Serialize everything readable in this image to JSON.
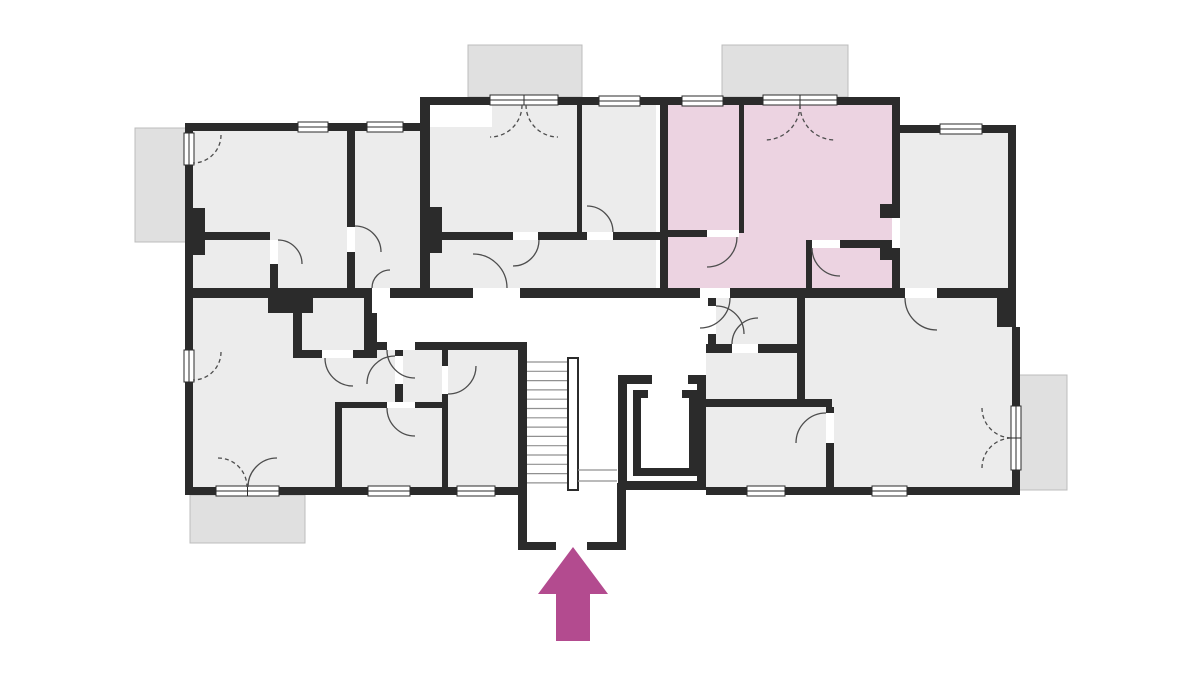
{
  "canvas": {
    "width": 1200,
    "height": 675,
    "background": "#ffffff"
  },
  "palette": {
    "wall": "#2b2b2b",
    "room": "#ececec",
    "highlight_room": "#ecd3e1",
    "balcony_fill": "#e0e0e0",
    "balcony_stroke": "#bcbcbc",
    "door_arc": "#4d4d4d",
    "stair_line": "#909090",
    "window_line": "#2b2b2b",
    "arrow": "#b34b8f",
    "white": "#ffffff"
  },
  "balconies": [
    {
      "x": 135,
      "y": 128,
      "w": 52,
      "h": 114
    },
    {
      "x": 468,
      "y": 45,
      "w": 114,
      "h": 52
    },
    {
      "x": 722,
      "y": 45,
      "w": 126,
      "h": 52
    },
    {
      "x": 190,
      "y": 495,
      "w": 115,
      "h": 48
    },
    {
      "x": 1018,
      "y": 375,
      "w": 49,
      "h": 115
    }
  ],
  "rooms": [
    {
      "x": 189,
      "y": 127,
      "w": 235,
      "h": 169,
      "highlight": false
    },
    {
      "x": 426,
      "y": 103,
      "w": 230,
      "h": 193,
      "highlight": false
    },
    {
      "x": 664,
      "y": 103,
      "w": 232,
      "h": 193,
      "highlight": true
    },
    {
      "x": 896,
      "y": 129,
      "w": 112,
      "h": 167,
      "highlight": false
    },
    {
      "x": 189,
      "y": 293,
      "w": 334,
      "h": 198,
      "highlight": false
    },
    {
      "x": 706,
      "y": 293,
      "w": 306,
      "h": 198,
      "highlight": false
    }
  ],
  "white_areas": [
    {
      "x": 372,
      "y": 293,
      "w": 344,
      "h": 57
    },
    {
      "x": 430,
      "y": 105,
      "w": 62,
      "h": 22
    }
  ],
  "walls": [
    {
      "x": 185,
      "y": 123,
      "w": 8,
      "h": 372
    },
    {
      "x": 185,
      "y": 123,
      "w": 243,
      "h": 8
    },
    {
      "x": 420,
      "y": 97,
      "w": 10,
      "h": 201
    },
    {
      "x": 420,
      "y": 97,
      "w": 240,
      "h": 8
    },
    {
      "x": 660,
      "y": 97,
      "w": 8,
      "h": 201
    },
    {
      "x": 660,
      "y": 97,
      "w": 240,
      "h": 8
    },
    {
      "x": 892,
      "y": 97,
      "w": 8,
      "h": 201
    },
    {
      "x": 892,
      "y": 125,
      "w": 124,
      "h": 8
    },
    {
      "x": 1008,
      "y": 125,
      "w": 8,
      "h": 178
    },
    {
      "x": 997,
      "y": 293,
      "w": 19,
      "h": 34
    },
    {
      "x": 1012,
      "y": 327,
      "w": 8,
      "h": 168
    },
    {
      "x": 185,
      "y": 487,
      "w": 342,
      "h": 8
    },
    {
      "x": 706,
      "y": 487,
      "w": 314,
      "h": 8
    },
    {
      "x": 185,
      "y": 288,
      "w": 187,
      "h": 10
    },
    {
      "x": 390,
      "y": 288,
      "w": 83,
      "h": 10
    },
    {
      "x": 520,
      "y": 288,
      "w": 180,
      "h": 10
    },
    {
      "x": 730,
      "y": 288,
      "w": 175,
      "h": 10
    },
    {
      "x": 937,
      "y": 288,
      "w": 79,
      "h": 10
    },
    {
      "x": 364,
      "y": 288,
      "w": 8,
      "h": 62
    },
    {
      "x": 364,
      "y": 342,
      "w": 23,
      "h": 8
    },
    {
      "x": 415,
      "y": 342,
      "w": 112,
      "h": 8
    },
    {
      "x": 708,
      "y": 298,
      "w": 8,
      "h": 8
    },
    {
      "x": 708,
      "y": 334,
      "w": 8,
      "h": 16
    },
    {
      "x": 518,
      "y": 348,
      "w": 9,
      "h": 202
    },
    {
      "x": 617,
      "y": 483,
      "w": 9,
      "h": 67
    },
    {
      "x": 518,
      "y": 542,
      "w": 38,
      "h": 8
    },
    {
      "x": 587,
      "y": 542,
      "w": 39,
      "h": 8
    },
    {
      "x": 347,
      "y": 131,
      "w": 8,
      "h": 96
    },
    {
      "x": 347,
      "y": 252,
      "w": 8,
      "h": 36
    },
    {
      "x": 185,
      "y": 208,
      "w": 20,
      "h": 47
    },
    {
      "x": 205,
      "y": 232,
      "w": 65,
      "h": 8
    },
    {
      "x": 270,
      "y": 264,
      "w": 8,
      "h": 24
    },
    {
      "x": 430,
      "y": 207,
      "w": 12,
      "h": 46
    },
    {
      "x": 577,
      "y": 105,
      "w": 5,
      "h": 128
    },
    {
      "x": 430,
      "y": 232,
      "w": 83,
      "h": 8
    },
    {
      "x": 538,
      "y": 232,
      "w": 49,
      "h": 8
    },
    {
      "x": 613,
      "y": 232,
      "w": 47,
      "h": 8
    },
    {
      "x": 739,
      "y": 105,
      "w": 5,
      "h": 128
    },
    {
      "x": 664,
      "y": 230,
      "w": 43,
      "h": 7
    },
    {
      "x": 840,
      "y": 240,
      "w": 52,
      "h": 8
    },
    {
      "x": 806,
      "y": 240,
      "w": 6,
      "h": 50
    },
    {
      "x": 880,
      "y": 204,
      "w": 18,
      "h": 14
    },
    {
      "x": 880,
      "y": 248,
      "w": 18,
      "h": 12
    },
    {
      "x": 268,
      "y": 298,
      "w": 45,
      "h": 15
    },
    {
      "x": 293,
      "y": 313,
      "w": 9,
      "h": 37
    },
    {
      "x": 370,
      "y": 313,
      "w": 7,
      "h": 37
    },
    {
      "x": 293,
      "y": 350,
      "w": 29,
      "h": 8
    },
    {
      "x": 353,
      "y": 350,
      "w": 24,
      "h": 8
    },
    {
      "x": 395,
      "y": 350,
      "w": 8,
      "h": 6
    },
    {
      "x": 395,
      "y": 384,
      "w": 8,
      "h": 18
    },
    {
      "x": 335,
      "y": 408,
      "w": 7,
      "h": 80
    },
    {
      "x": 335,
      "y": 402,
      "w": 52,
      "h": 6
    },
    {
      "x": 415,
      "y": 402,
      "w": 33,
      "h": 6
    },
    {
      "x": 442,
      "y": 348,
      "w": 6,
      "h": 18
    },
    {
      "x": 442,
      "y": 394,
      "w": 6,
      "h": 94
    },
    {
      "x": 706,
      "y": 344,
      "w": 26,
      "h": 9
    },
    {
      "x": 758,
      "y": 344,
      "w": 47,
      "h": 9
    },
    {
      "x": 797,
      "y": 298,
      "w": 8,
      "h": 102
    },
    {
      "x": 706,
      "y": 399,
      "w": 126,
      "h": 8
    },
    {
      "x": 826,
      "y": 407,
      "w": 8,
      "h": 6
    },
    {
      "x": 826,
      "y": 443,
      "w": 8,
      "h": 45
    }
  ],
  "elevator_walls": [
    {
      "x": 618,
      "y": 375,
      "w": 9,
      "h": 115
    },
    {
      "x": 697,
      "y": 375,
      "w": 9,
      "h": 115
    },
    {
      "x": 618,
      "y": 481,
      "w": 88,
      "h": 9
    },
    {
      "x": 618,
      "y": 375,
      "w": 34,
      "h": 9
    },
    {
      "x": 688,
      "y": 375,
      "w": 18,
      "h": 9
    },
    {
      "x": 633,
      "y": 390,
      "w": 8,
      "h": 86
    },
    {
      "x": 689,
      "y": 390,
      "w": 8,
      "h": 86
    },
    {
      "x": 633,
      "y": 468,
      "w": 64,
      "h": 8
    },
    {
      "x": 633,
      "y": 390,
      "w": 15,
      "h": 8
    },
    {
      "x": 682,
      "y": 390,
      "w": 15,
      "h": 8
    }
  ],
  "thresholds": [
    {
      "x": 372,
      "y": 288,
      "w": 18,
      "h": 10
    },
    {
      "x": 473,
      "y": 288,
      "w": 47,
      "h": 10
    },
    {
      "x": 700,
      "y": 288,
      "w": 30,
      "h": 10
    },
    {
      "x": 905,
      "y": 288,
      "w": 32,
      "h": 10
    },
    {
      "x": 387,
      "y": 342,
      "w": 28,
      "h": 8
    },
    {
      "x": 708,
      "y": 306,
      "w": 8,
      "h": 28
    },
    {
      "x": 387,
      "y": 402,
      "w": 28,
      "h": 6
    },
    {
      "x": 732,
      "y": 344,
      "w": 26,
      "h": 9
    },
    {
      "x": 395,
      "y": 356,
      "w": 8,
      "h": 28
    },
    {
      "x": 442,
      "y": 366,
      "w": 6,
      "h": 28
    },
    {
      "x": 826,
      "y": 413,
      "w": 8,
      "h": 30
    },
    {
      "x": 892,
      "y": 218,
      "w": 8,
      "h": 30
    },
    {
      "x": 513,
      "y": 232,
      "w": 25,
      "h": 8
    },
    {
      "x": 587,
      "y": 232,
      "w": 26,
      "h": 8
    },
    {
      "x": 707,
      "y": 230,
      "w": 32,
      "h": 7
    },
    {
      "x": 812,
      "y": 240,
      "w": 28,
      "h": 8
    },
    {
      "x": 347,
      "y": 227,
      "w": 8,
      "h": 25
    },
    {
      "x": 270,
      "y": 240,
      "w": 8,
      "h": 24
    },
    {
      "x": 322,
      "y": 350,
      "w": 31,
      "h": 8
    }
  ],
  "windows": [
    {
      "x": 298,
      "y": 122,
      "w": 30,
      "h": 10,
      "mullion": false
    },
    {
      "x": 367,
      "y": 122,
      "w": 36,
      "h": 10,
      "mullion": false
    },
    {
      "x": 599,
      "y": 96,
      "w": 41,
      "h": 10,
      "mullion": false
    },
    {
      "x": 682,
      "y": 96,
      "w": 41,
      "h": 10,
      "mullion": false
    },
    {
      "x": 940,
      "y": 124,
      "w": 42,
      "h": 10,
      "mullion": false
    },
    {
      "x": 368,
      "y": 486,
      "w": 42,
      "h": 10,
      "mullion": false
    },
    {
      "x": 457,
      "y": 486,
      "w": 38,
      "h": 10,
      "mullion": false
    },
    {
      "x": 747,
      "y": 486,
      "w": 38,
      "h": 10,
      "mullion": false
    },
    {
      "x": 872,
      "y": 486,
      "w": 35,
      "h": 10,
      "mullion": false
    },
    {
      "x": 184,
      "y": 133,
      "w": 10,
      "h": 32,
      "mullion": false
    },
    {
      "x": 184,
      "y": 350,
      "w": 10,
      "h": 32,
      "mullion": false
    },
    {
      "x": 1011,
      "y": 406,
      "w": 10,
      "h": 64,
      "mullion": true
    },
    {
      "x": 490,
      "y": 95,
      "w": 68,
      "h": 10,
      "mullion": true
    },
    {
      "x": 763,
      "y": 95,
      "w": 74,
      "h": 10,
      "mullion": true
    },
    {
      "x": 216,
      "y": 486,
      "w": 63,
      "h": 10,
      "mullion": true
    }
  ],
  "door_arcs": [
    {
      "d": "M 221,135 A 28 28 0 0 1 193,163",
      "dashed": true
    },
    {
      "d": "M 221,352 A 28 28 0 0 1 193,380",
      "dashed": true
    },
    {
      "d": "M 218,458 A 29 29 0 0 1 247,487",
      "dashed": true
    },
    {
      "d": "M 277,458 A 29 29 0 0 0 248,487",
      "dashed": false
    },
    {
      "d": "M 522,105 A 32 32 0 0 1 490,137",
      "dashed": true
    },
    {
      "d": "M 526,105 A 32 32 0 0 0 558,137",
      "dashed": true
    },
    {
      "d": "M 800,105 A 35 35 0 0 1 765,140",
      "dashed": true
    },
    {
      "d": "M 800,105 A 35 35 0 0 0 835,140",
      "dashed": true
    },
    {
      "d": "M 982,408 A 30 30 0 0 0 1012,438",
      "dashed": true
    },
    {
      "d": "M 982,468 A 30 30 0 0 1 1012,438",
      "dashed": true
    },
    {
      "d": "M 372,288 A 18 18 0 0 1 390,270",
      "dashed": false
    },
    {
      "d": "M 507,288 A 34 34 0 0 0 473,254",
      "dashed": false
    },
    {
      "d": "M 730,298 A 30 30 0 0 1 700,328",
      "dashed": false
    },
    {
      "d": "M 716,306 A 28 28 0 0 1 744,334",
      "dashed": false
    },
    {
      "d": "M 905,298 A 32 32 0 0 0 937,330",
      "dashed": false
    },
    {
      "d": "M 387,350 A 28 28 0 0 0 415,378",
      "dashed": false
    },
    {
      "d": "M 387,408 A 28 28 0 0 0 415,436",
      "dashed": false
    },
    {
      "d": "M 476,366 A 28 28 0 0 1 448,394",
      "dashed": false
    },
    {
      "d": "M 325,358 A 28 28 0 0 0 353,386",
      "dashed": false
    },
    {
      "d": "M 395,356 A 28 28 0 0 0 367,384",
      "dashed": false
    },
    {
      "d": "M 355,226 A 26 26 0 0 1 381,252",
      "dashed": false
    },
    {
      "d": "M 278,240 A 24 24 0 0 1 302,264",
      "dashed": false
    },
    {
      "d": "M 539,240 A 26 26 0 0 1 513,266",
      "dashed": false
    },
    {
      "d": "M 613,232 A 26 26 0 0 0 587,206",
      "dashed": false
    },
    {
      "d": "M 737,237 A 30 30 0 0 1 707,267",
      "dashed": false
    },
    {
      "d": "M 812,248 A 28 28 0 0 0 840,276",
      "dashed": false
    },
    {
      "d": "M 732,344 A 26 26 0 0 1 758,318",
      "dashed": false
    },
    {
      "d": "M 826,413 A 30 30 0 0 0 796,443",
      "dashed": false
    }
  ],
  "stairs": {
    "tread_x1": 527,
    "tread_x2": 567,
    "tread_y_start": 362,
    "tread_step": 9.3,
    "tread_count": 14,
    "landing": {
      "x": 568,
      "y": 358,
      "w": 10,
      "h": 132
    },
    "lower_flight_lines": [
      {
        "x1": 578,
        "y1": 470,
        "x2": 617,
        "y2": 470
      },
      {
        "x1": 578,
        "y1": 481,
        "x2": 617,
        "y2": 481
      }
    ]
  },
  "entrance_arrow": {
    "points": "573,547 538,594 556,594 556,641 590,641 590,594 608,594"
  }
}
